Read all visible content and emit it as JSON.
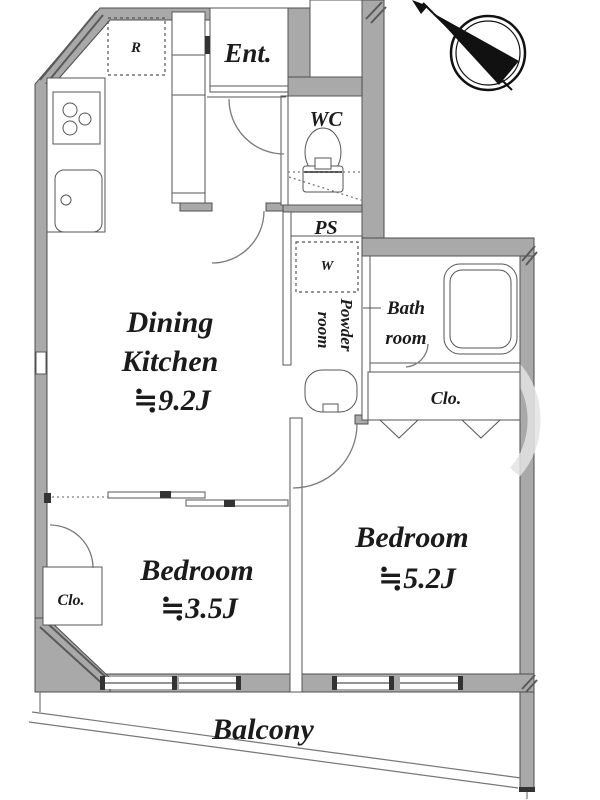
{
  "colors": {
    "background": "#ffffff",
    "wall_fill": "#a9a9a9",
    "wall_outline": "#4d4d4d",
    "thin_line": "#555555",
    "door_arc": "#7a7a7a",
    "text": "#1b1b1b",
    "compass": "#111111",
    "watermark": "#e3e3e3"
  },
  "rooms": {
    "dining_kitchen": {
      "line1": "Dining",
      "line2": "Kitchen",
      "size": "≒9.2J"
    },
    "bedroom_small": {
      "name": "Bedroom",
      "size": "≒3.5J"
    },
    "bedroom_large": {
      "name": "Bedroom",
      "size": "≒5.2J"
    },
    "balcony": {
      "label": "Balcony"
    },
    "entrance": {
      "label": "Ent."
    },
    "wc": {
      "label": "WC"
    },
    "pipe_space": {
      "label": "PS"
    },
    "powder_room": {
      "line1": "Powder",
      "line2": "room"
    },
    "bath_room": {
      "line1": "Bath",
      "line2": "room"
    },
    "closet_bedroom_large": {
      "label": "Clo."
    },
    "closet_bedroom_small": {
      "label": "Clo."
    },
    "refrigerator_space": {
      "label": "R"
    },
    "washer_space": {
      "label": "W"
    }
  }
}
